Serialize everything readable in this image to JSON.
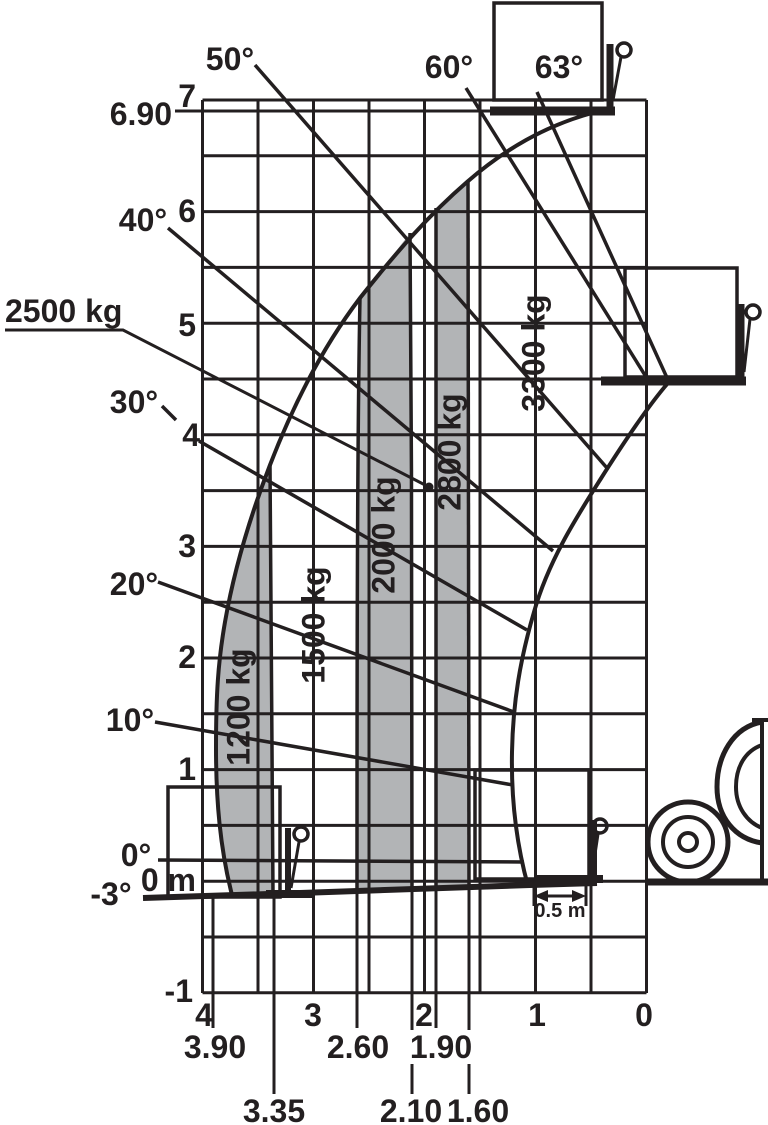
{
  "figure": {
    "kind": "telehandler-load-capacity-chart",
    "ink_color": "#231f20",
    "zone_fill_color": "#b2b4b6",
    "background": "#ffffff"
  },
  "labels": {
    "angles": {
      "50": "50°",
      "60": "60°",
      "63": "63°",
      "40": "40°",
      "30": "30°",
      "20": "20°",
      "10": "10°",
      "0": "0°",
      "neg3": "-3°"
    },
    "heights": {
      "7": "7",
      "6": "6",
      "5": "5",
      "4": "4",
      "3": "3",
      "2": "2",
      "1": "1",
      "0": "0 m",
      "neg1": "-1",
      "max": "6.90"
    },
    "reaches": {
      "4": "4",
      "3": "3",
      "2": "2",
      "1": "1",
      "0": "0"
    },
    "reach_marks": {
      "390": "3.90",
      "335": "3.35",
      "260": "2.60",
      "210": "2.10",
      "190": "1.90",
      "160": "1.60"
    },
    "capacities": {
      "1200": "1200 kg",
      "1500": "1500 kg",
      "2000": "2000 kg",
      "2500": "2500 kg",
      "2800": "2800 kg",
      "3300": "3300 kg"
    },
    "dim": "0.5 m"
  },
  "chart_data": {
    "type": "load-chart",
    "title": "",
    "xlabel": "reach (m)",
    "ylabel": "lift height (m)",
    "x_axis": {
      "range": [
        0,
        4
      ],
      "ticks": [
        4,
        3,
        2,
        1,
        0
      ],
      "direction": "reversed",
      "grid_step_m": 0.5
    },
    "y_axis": {
      "range": [
        -1,
        7
      ],
      "ticks": [
        7,
        6,
        5,
        4,
        3,
        2,
        1,
        0,
        -1
      ],
      "grid_step_m": 0.5
    },
    "grid": true,
    "max_lift_height_m": 6.9,
    "boom_angles_deg": [
      -3,
      0,
      10,
      20,
      30,
      40,
      50,
      60,
      63
    ],
    "reach_boundaries_m": [
      3.9,
      3.35,
      2.6,
      2.1,
      1.9,
      1.6
    ],
    "load_zones": [
      {
        "capacity_kg": 1200,
        "reach_from_m": 3.9,
        "reach_to_m": 3.35,
        "shaded": true
      },
      {
        "capacity_kg": 1500,
        "reach_from_m": 3.35,
        "reach_to_m": 2.6,
        "shaded": false
      },
      {
        "capacity_kg": 2000,
        "reach_from_m": 2.6,
        "reach_to_m": 2.1,
        "shaded": true
      },
      {
        "capacity_kg": 2500,
        "reach_from_m": 2.1,
        "reach_to_m": 1.9,
        "shaded": false,
        "labeled_by": "leader-line-with-dot"
      },
      {
        "capacity_kg": 2800,
        "reach_from_m": 1.9,
        "reach_to_m": 1.6,
        "shaded": true
      },
      {
        "capacity_kg": 3300,
        "reach_from_m": 1.6,
        "reach_to_m": 0.5,
        "shaded": false
      }
    ],
    "dimension_annotation": {
      "text": "0.5 m",
      "meaning": "distance from front of machine"
    },
    "annotations": "fork icons with load boxes drawn at -3°/ground, mid (≈4.5 m) and top (6.90 m at 63°) boom positions; machine front wheel silhouette at lower right"
  }
}
